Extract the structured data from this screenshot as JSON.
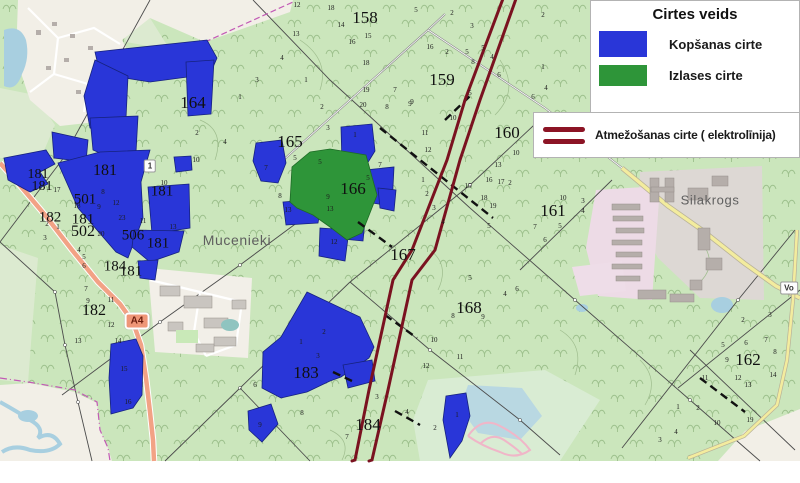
{
  "legend": {
    "title": "Cirtes veids",
    "items": [
      {
        "label": "Kopšanas cirte",
        "swatch": "blue",
        "color": "#2936d8"
      },
      {
        "label": "Izlases cirte",
        "swatch": "green",
        "color": "#2e9539"
      },
      {
        "label": "Atmežošanas cirte ( elektrolīnija)",
        "swatch": "double-line",
        "color": "#8c1425"
      }
    ]
  },
  "map": {
    "colors": {
      "forest_base": "#cbe6bc",
      "cut_blue": "#2936d8",
      "cut_green": "#2e9539",
      "powerline_red": "#7a1220",
      "open_land": "#f2efe7",
      "water": "#a8cfe0",
      "industrial_pink": "#eddbe6"
    },
    "place_names": [
      [
        237,
        240,
        "Mucenieki",
        14
      ],
      [
        710,
        200,
        "Silakrogs",
        13
      ]
    ],
    "road_shield": {
      "text": "A4",
      "x": 137,
      "y": 321
    },
    "badges": [
      {
        "text": "1",
        "x": 150,
        "y": 166
      },
      {
        "text": "Vo",
        "x": 789,
        "y": 288
      }
    ],
    "compartment_labels": [
      [
        365,
        18,
        "158",
        17
      ],
      [
        442,
        80,
        "159",
        17
      ],
      [
        507,
        133,
        "160",
        17
      ],
      [
        553,
        211,
        "161",
        17
      ],
      [
        748,
        360,
        "162",
        17
      ],
      [
        193,
        103,
        "164",
        17
      ],
      [
        290,
        142,
        "165",
        17
      ],
      [
        353,
        189,
        "166",
        17
      ],
      [
        403,
        255,
        "167",
        17
      ],
      [
        469,
        308,
        "168",
        17
      ],
      [
        105,
        171,
        "181",
        16
      ],
      [
        38,
        175,
        "181",
        14
      ],
      [
        42,
        187,
        "181",
        14
      ],
      [
        162,
        192,
        "181",
        15
      ],
      [
        83,
        220,
        "181",
        15
      ],
      [
        50,
        218,
        "182",
        15
      ],
      [
        85,
        200,
        "501",
        15
      ],
      [
        83,
        232,
        "502",
        16
      ],
      [
        133,
        236,
        "506",
        15
      ],
      [
        158,
        244,
        "181",
        15
      ],
      [
        115,
        267,
        "184",
        15
      ],
      [
        131,
        272,
        "181",
        15
      ],
      [
        94,
        311,
        "182",
        16
      ],
      [
        306,
        373,
        "183",
        17
      ],
      [
        368,
        425,
        "184",
        17
      ]
    ],
    "parcel_numbers": [
      [
        297,
        5,
        "12"
      ],
      [
        331,
        8,
        "18"
      ],
      [
        341,
        25,
        "14"
      ],
      [
        296,
        34,
        "13"
      ],
      [
        352,
        42,
        "16"
      ],
      [
        368,
        36,
        "15"
      ],
      [
        282,
        58,
        "4"
      ],
      [
        366,
        63,
        "18"
      ],
      [
        306,
        80,
        "1"
      ],
      [
        366,
        90,
        "19"
      ],
      [
        395,
        90,
        "7"
      ],
      [
        363,
        105,
        "20"
      ],
      [
        387,
        107,
        "8"
      ],
      [
        322,
        107,
        "2"
      ],
      [
        410,
        104,
        "9"
      ],
      [
        328,
        128,
        "3"
      ],
      [
        425,
        133,
        "11"
      ],
      [
        428,
        150,
        "12"
      ],
      [
        416,
        10,
        "5"
      ],
      [
        452,
        13,
        "2"
      ],
      [
        472,
        26,
        "3"
      ],
      [
        430,
        47,
        "16"
      ],
      [
        447,
        52,
        "2"
      ],
      [
        467,
        52,
        "5"
      ],
      [
        483,
        48,
        "5"
      ],
      [
        492,
        57,
        "4"
      ],
      [
        473,
        62,
        "8"
      ],
      [
        499,
        75,
        "6"
      ],
      [
        470,
        93,
        "5"
      ],
      [
        453,
        118,
        "10"
      ],
      [
        412,
        102,
        "9"
      ],
      [
        543,
        67,
        "1"
      ],
      [
        546,
        88,
        "4"
      ],
      [
        533,
        97,
        "6"
      ],
      [
        543,
        15,
        "2"
      ],
      [
        516,
        153,
        "10"
      ],
      [
        498,
        165,
        "13"
      ],
      [
        489,
        180,
        "16"
      ],
      [
        501,
        182,
        "17"
      ],
      [
        468,
        186,
        "15"
      ],
      [
        484,
        198,
        "18"
      ],
      [
        493,
        206,
        "19"
      ],
      [
        423,
        180,
        "1"
      ],
      [
        427,
        194,
        "2"
      ],
      [
        434,
        208,
        "3"
      ],
      [
        443,
        222,
        "4"
      ],
      [
        489,
        226,
        "5"
      ],
      [
        563,
        198,
        "10"
      ],
      [
        583,
        201,
        "3"
      ],
      [
        583,
        211,
        "4"
      ],
      [
        560,
        226,
        "5"
      ],
      [
        535,
        227,
        "7"
      ],
      [
        545,
        240,
        "6"
      ],
      [
        510,
        183,
        "2"
      ],
      [
        196,
        160,
        "10"
      ],
      [
        266,
        168,
        "7"
      ],
      [
        295,
        158,
        "5"
      ],
      [
        320,
        162,
        "5"
      ],
      [
        280,
        196,
        "8"
      ],
      [
        288,
        210,
        "13"
      ],
      [
        328,
        197,
        "9"
      ],
      [
        330,
        209,
        "13"
      ],
      [
        355,
        135,
        "1"
      ],
      [
        380,
        165,
        "7"
      ],
      [
        368,
        178,
        "5"
      ],
      [
        334,
        242,
        "12"
      ],
      [
        257,
        80,
        "3"
      ],
      [
        240,
        97,
        "1"
      ],
      [
        197,
        133,
        "2"
      ],
      [
        225,
        142,
        "4"
      ],
      [
        470,
        278,
        "5"
      ],
      [
        517,
        289,
        "6"
      ],
      [
        505,
        294,
        "4"
      ],
      [
        453,
        316,
        "8"
      ],
      [
        483,
        317,
        "9"
      ],
      [
        434,
        340,
        "10"
      ],
      [
        460,
        357,
        "11"
      ],
      [
        426,
        366,
        "12"
      ],
      [
        743,
        320,
        "2"
      ],
      [
        770,
        315,
        "3"
      ],
      [
        723,
        345,
        "5"
      ],
      [
        746,
        343,
        "6"
      ],
      [
        766,
        340,
        "7"
      ],
      [
        775,
        352,
        "8"
      ],
      [
        727,
        360,
        "9"
      ],
      [
        738,
        378,
        "12"
      ],
      [
        748,
        385,
        "13"
      ],
      [
        705,
        378,
        "11"
      ],
      [
        773,
        375,
        "14"
      ],
      [
        678,
        407,
        "1"
      ],
      [
        698,
        408,
        "2"
      ],
      [
        717,
        423,
        "10"
      ],
      [
        750,
        420,
        "19"
      ],
      [
        660,
        440,
        "3"
      ],
      [
        676,
        432,
        "4"
      ],
      [
        103,
        192,
        "8"
      ],
      [
        116,
        203,
        "12"
      ],
      [
        99,
        207,
        "9"
      ],
      [
        122,
        218,
        "23"
      ],
      [
        101,
        234,
        "20"
      ],
      [
        143,
        221,
        "11"
      ],
      [
        164,
        183,
        "10"
      ],
      [
        173,
        227,
        "13"
      ],
      [
        57,
        190,
        "17"
      ],
      [
        77,
        206,
        "18"
      ],
      [
        47,
        224,
        "2"
      ],
      [
        58,
        227,
        "1"
      ],
      [
        45,
        238,
        "3"
      ],
      [
        79,
        250,
        "4"
      ],
      [
        84,
        257,
        "5"
      ],
      [
        84,
        266,
        "6"
      ],
      [
        86,
        289,
        "7"
      ],
      [
        88,
        301,
        "9"
      ],
      [
        111,
        300,
        "11"
      ],
      [
        111,
        325,
        "12"
      ],
      [
        78,
        341,
        "13"
      ],
      [
        118,
        341,
        "14"
      ],
      [
        124,
        369,
        "15"
      ],
      [
        128,
        402,
        "16"
      ],
      [
        301,
        342,
        "1"
      ],
      [
        324,
        332,
        "2"
      ],
      [
        318,
        356,
        "3"
      ],
      [
        255,
        385,
        "6"
      ],
      [
        260,
        425,
        "9"
      ],
      [
        302,
        413,
        "8"
      ],
      [
        377,
        397,
        "3"
      ],
      [
        407,
        412,
        "4"
      ],
      [
        347,
        437,
        "7"
      ],
      [
        435,
        428,
        "2"
      ],
      [
        457,
        415,
        "1"
      ]
    ]
  }
}
